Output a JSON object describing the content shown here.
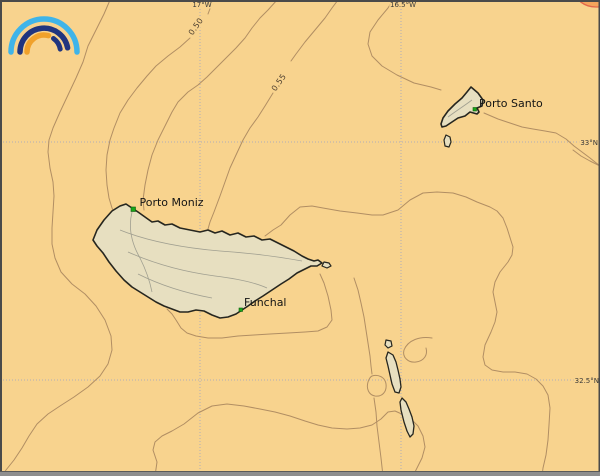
{
  "map": {
    "type": "nautical-weather-chart",
    "region": "Madeira archipelago",
    "colors": {
      "sea": "#F8D38E",
      "land": "#E7DFC0",
      "coastline": "#26261F",
      "isoline": "#B18E63",
      "island_relief": "#A09F90",
      "graticule": "#B0AEB8",
      "marker_green": "#19A619"
    },
    "graticule": {
      "meridians": [
        {
          "label": "17°W"
        },
        {
          "label": "16.5°W"
        }
      ],
      "parallels": [
        {
          "label": "33°N"
        },
        {
          "label": "32.5°N"
        }
      ]
    },
    "isolines": {
      "labels": [
        {
          "text": "0.50"
        },
        {
          "text": "0.55"
        }
      ]
    },
    "places": [
      {
        "name": "Porto Moniz"
      },
      {
        "name": "Funchal"
      },
      {
        "name": "Porto Santo"
      }
    ],
    "logo": {
      "description": "rainbow-arcs-logo",
      "arc_colors": [
        "#3FB4E9",
        "#20357F",
        "#F0A12B",
        "#20357F"
      ]
    },
    "corner_badge": {
      "fill": "#F4A45C",
      "stroke": "#E2674A"
    }
  }
}
